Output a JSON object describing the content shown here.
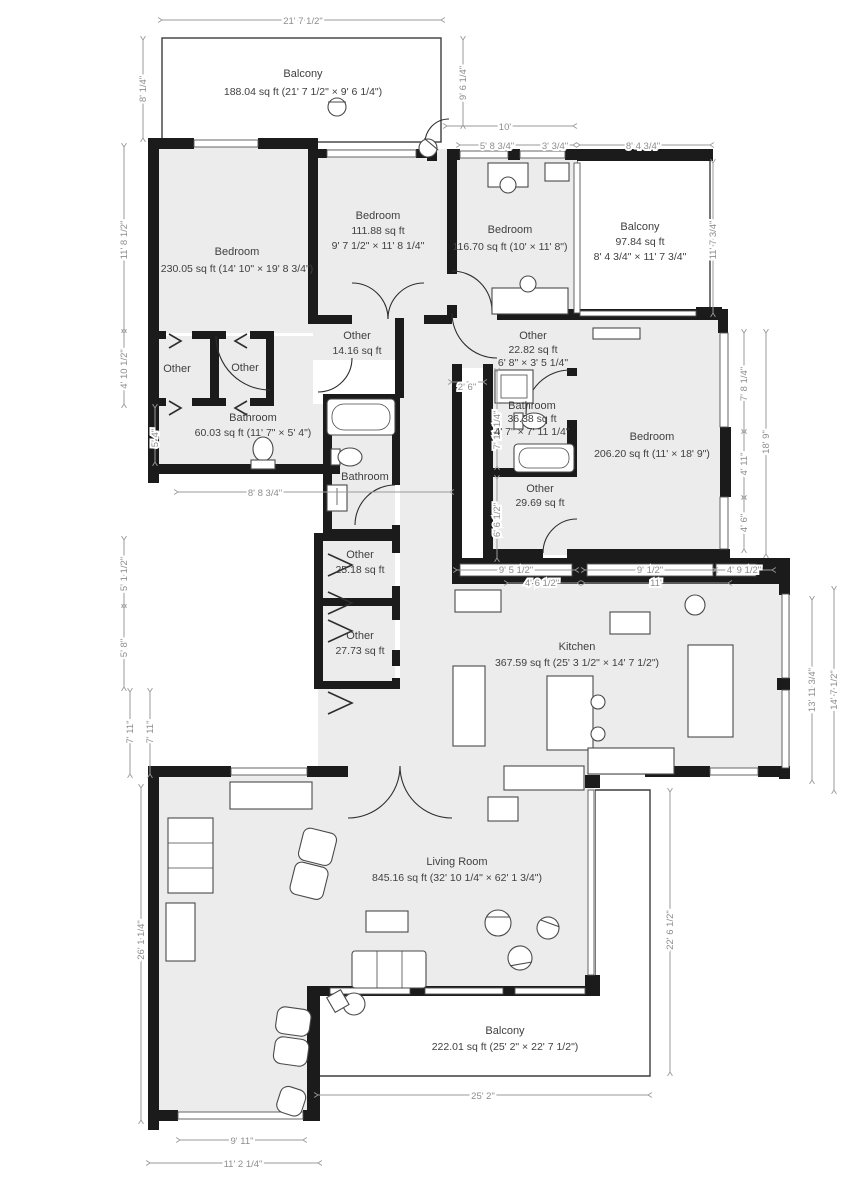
{
  "plan": {
    "rooms": [
      {
        "name": "Balcony",
        "area": "188.04 sq ft (21' 7 1/2\" × 9' 6 1/4\")"
      },
      {
        "name": "Bedroom",
        "area": "230.05 sq ft (14' 10\" × 19' 8 3/4\")"
      },
      {
        "name": "Bedroom",
        "area": "111.88 sq ft",
        "size": "9' 7 1/2\" × 11' 8 1/4\""
      },
      {
        "name": "Bedroom",
        "area": "116.70 sq ft (10' × 11' 8\")"
      },
      {
        "name": "Balcony",
        "area": "97.84 sq ft",
        "size": "8' 4 3/4\" × 11' 7 3/4\""
      },
      {
        "name": "Other"
      },
      {
        "name": "Other"
      },
      {
        "name": "Other",
        "area": "14.16 sq ft"
      },
      {
        "name": "Bathroom",
        "area": "60.03 sq ft (11' 7\" × 5' 4\")"
      },
      {
        "name": "Bathroom"
      },
      {
        "name": "Other",
        "area": "22.82 sq ft",
        "size": "6' 8\" × 3' 5 1/4\""
      },
      {
        "name": "Bathroom",
        "area": "36.38 sq ft",
        "size": "4' 7\" × 7' 11 1/4\""
      },
      {
        "name": "Bedroom",
        "area": "206.20 sq ft (11' × 18' 9\")"
      },
      {
        "name": "Other",
        "area": "29.69 sq ft"
      },
      {
        "name": "Other",
        "area": "25.18 sq ft"
      },
      {
        "name": "Other",
        "area": "27.73 sq ft"
      },
      {
        "name": "Kitchen",
        "area": "367.59 sq ft (25' 3 1/2\" × 14' 7 1/2\")"
      },
      {
        "name": "Living Room",
        "area": "845.16 sq ft (32' 10 1/4\" × 62' 1 3/4\")"
      },
      {
        "name": "Balcony",
        "area": "222.01 sq ft (25' 2\" × 22' 7 1/2\")"
      }
    ],
    "dimensions": [
      "21' 7 1/2\"",
      "8' 1/4\"",
      "9' 6 1/4\"",
      "10'",
      "5' 8 3/4\"",
      "3' 3/4\"",
      "8' 4 3/4\"",
      "11' 7 3/4\"",
      "11' 8 1/2\"",
      "4' 10 1/2\"",
      "5' 4\"",
      "8' 8 3/4\"",
      "2' 6\"",
      "7' 11 1/4\"",
      "6' 6 1/2\"",
      "7' 8 1/4\"",
      "4' 11\"",
      "4' 6\"",
      "18' 9\"",
      "9' 5 1/2\"",
      "4' 6 1/2\"",
      "9' 1/2\"",
      "11'",
      "4' 9 1/2\"",
      "5' 1 1/2\"",
      "5' 8\"",
      "7' 11\"",
      "7' 11\"",
      "13' 11 3/4\"",
      "14' 7 1/2\"",
      "26' 1 1/4\"",
      "22' 6 1/2\"",
      "25' 2\"",
      "9' 11\"",
      "11' 2 1/4\""
    ],
    "colors": {
      "wall": "#1b1b1b",
      "room_fill": "#ececec",
      "dim": "#9a9a9a",
      "text": "#3f3f3f"
    }
  }
}
